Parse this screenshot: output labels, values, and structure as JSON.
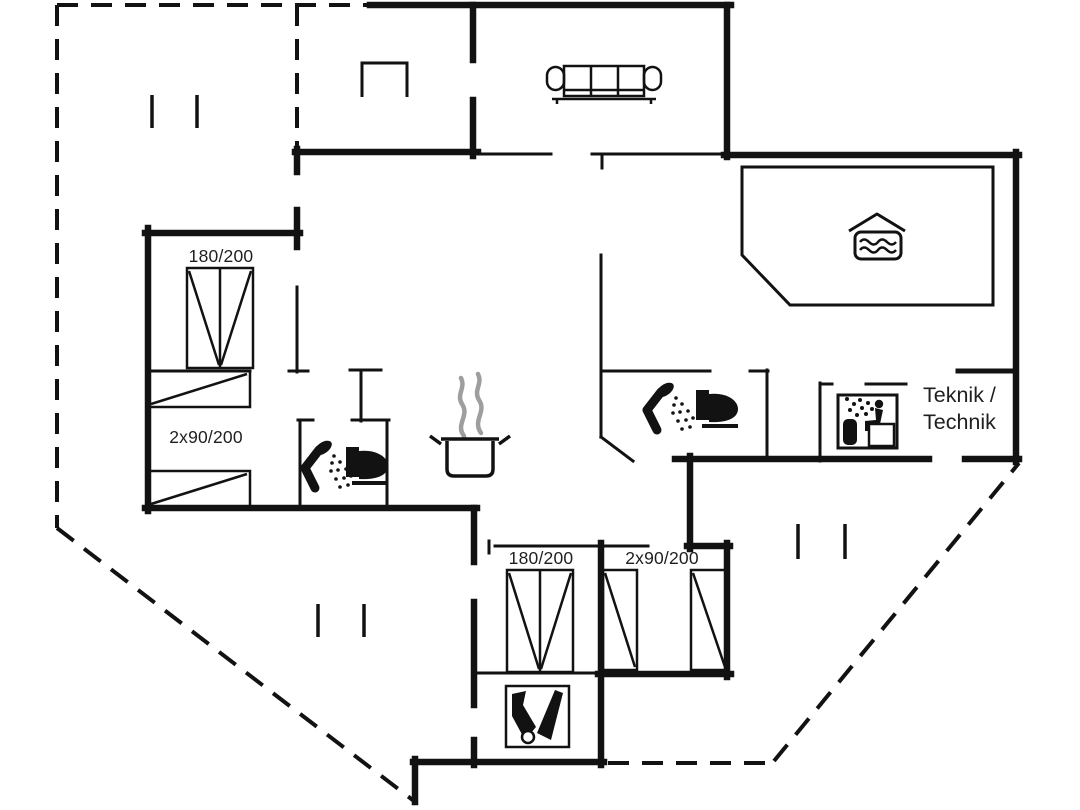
{
  "canvas": {
    "width": 1080,
    "height": 810,
    "background": "#ffffff",
    "line_color": "#121212",
    "steam_color": "#9e9e9e",
    "label_color": "#1f1f1f"
  },
  "labels": {
    "bedroom_left_double_bed": "180/200",
    "bedroom_left_single_beds": "2x90/200",
    "bedroom_bottom_double_bed": "180/200",
    "bedroom_bottom_single_beds": "2x90/200",
    "technical_room_line1": "Teknik /",
    "technical_room_line2": "Technik"
  },
  "icons": [
    "sofa-icon",
    "wood-stove-icon",
    "cooking-pot-icon",
    "steam-icon",
    "shower-icon",
    "toilet-icon",
    "spa-bath-icon",
    "sauna-icon",
    "cleaning-equipment-icon",
    "window-marker",
    "terrace-dashed-boundary"
  ]
}
